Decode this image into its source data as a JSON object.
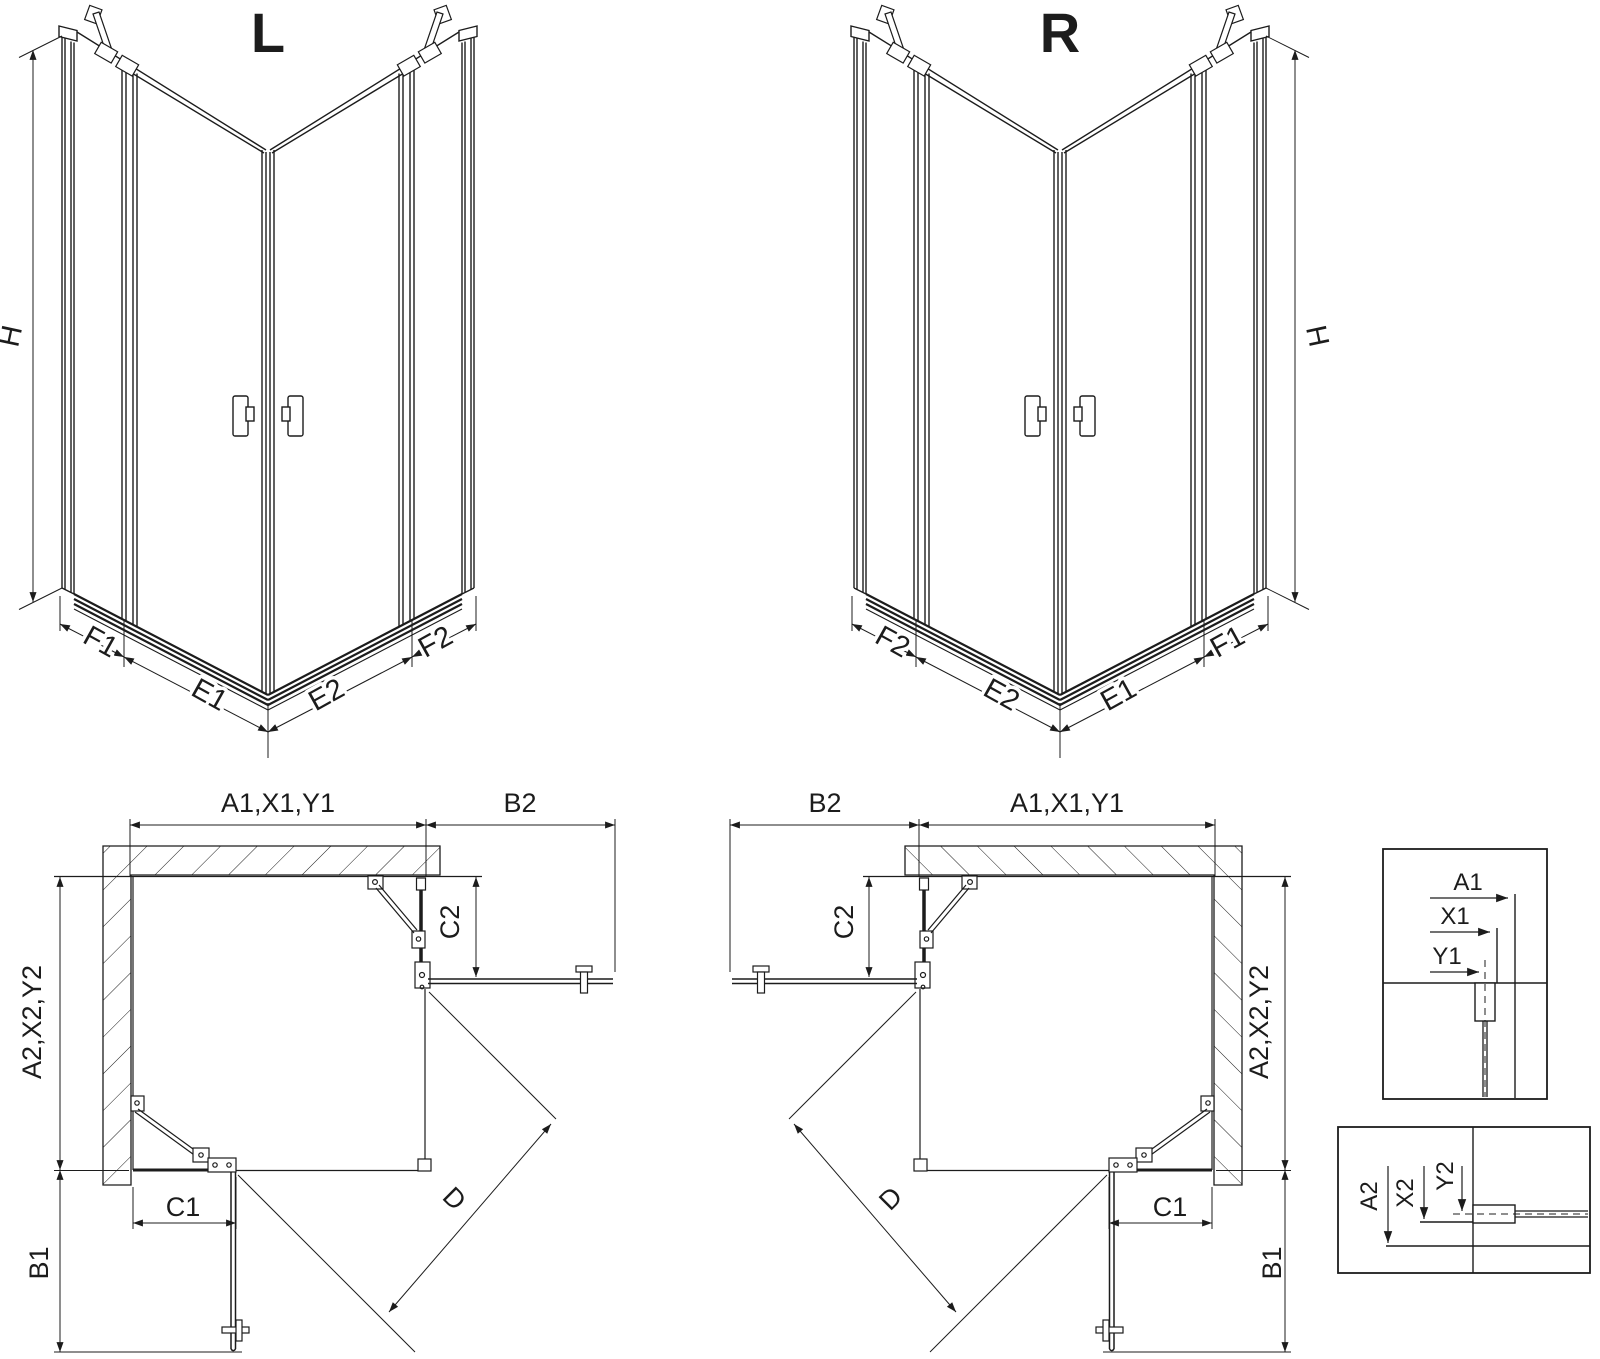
{
  "colors": {
    "line": "#1c1c1c",
    "background": "#ffffff"
  },
  "iso_left": {
    "title": "L",
    "height": "H",
    "f1": "F1",
    "e1": "E1",
    "e2": "E2",
    "f2": "F2"
  },
  "iso_right": {
    "title": "R",
    "height": "H",
    "f2": "F2",
    "e2": "E2",
    "e1": "E1",
    "f1": "F1"
  },
  "plan_left": {
    "top_span": "A1,X1,Y1",
    "door_open_top": "B2",
    "fixed_right": "C2",
    "side_span": "A2,X2,Y2",
    "door_open_side": "B1",
    "fixed_bottom": "C1",
    "diagonal": "D"
  },
  "plan_right": {
    "top_span": "A1,X1,Y1",
    "door_open_top": "B2",
    "fixed_left": "C2",
    "side_span": "A2,X2,Y2",
    "door_open_side": "B1",
    "fixed_bottom": "C1",
    "diagonal": "D"
  },
  "detail_wall_a": {
    "a1": "A1",
    "x1": "X1",
    "y1": "Y1"
  },
  "detail_wall_b": {
    "a2": "A2",
    "x2": "X2",
    "y2": "Y2"
  }
}
